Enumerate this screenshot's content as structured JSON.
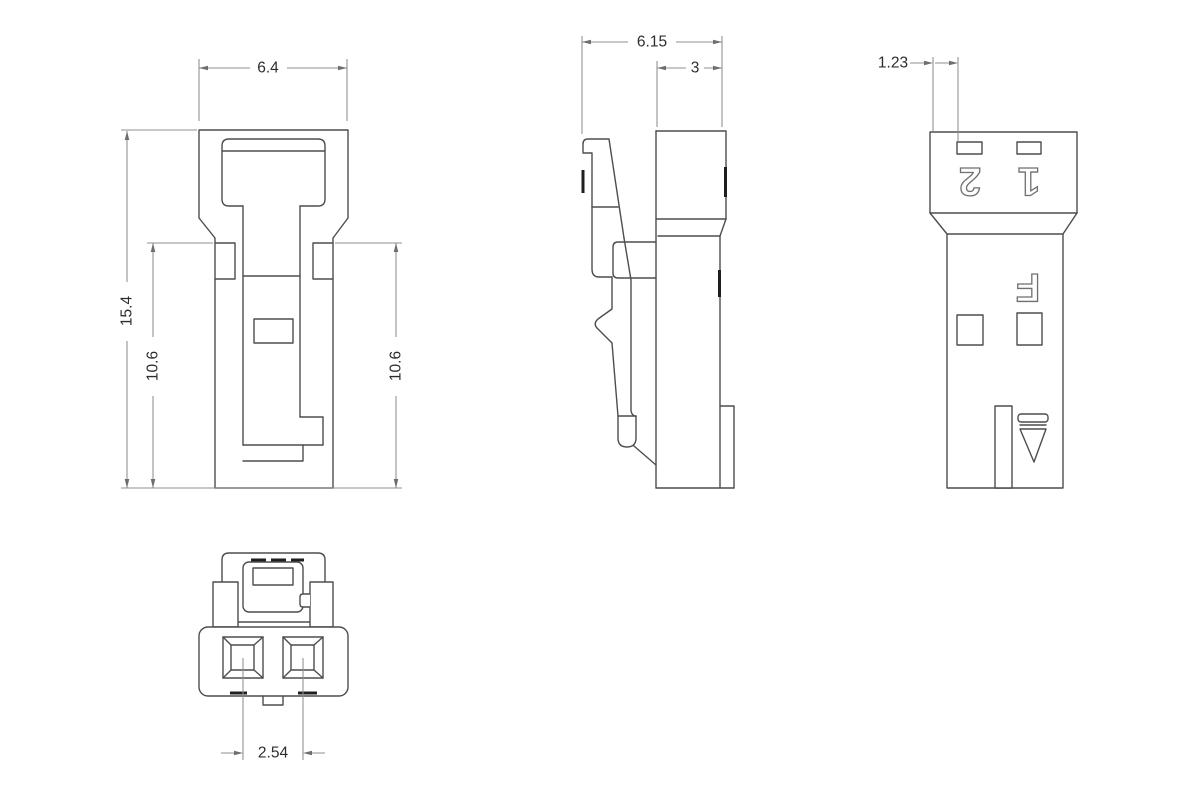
{
  "views": {
    "front": {
      "dims": {
        "width": "6.4",
        "overall_height": "15.4",
        "slot_height_left": "10.6",
        "slot_height_right": "10.6"
      }
    },
    "side": {
      "dims": {
        "overall_depth": "6.15",
        "body_depth": "3"
      }
    },
    "rear": {
      "dims": {
        "slot_offset": "1.23"
      },
      "markings": {
        "pin2": "2",
        "pin1": "1",
        "material_mark": "F"
      }
    },
    "bottom": {
      "dims": {
        "pin_pitch": "2.54"
      }
    }
  },
  "colors": {
    "background": "#ffffff",
    "part_outline": "#4d4d4d",
    "dimension_line": "#8f8f8f",
    "dimension_text": "#2d2d2d",
    "marking_outline": "#6f6f6f",
    "gate_mark": "#1f1f1f"
  }
}
